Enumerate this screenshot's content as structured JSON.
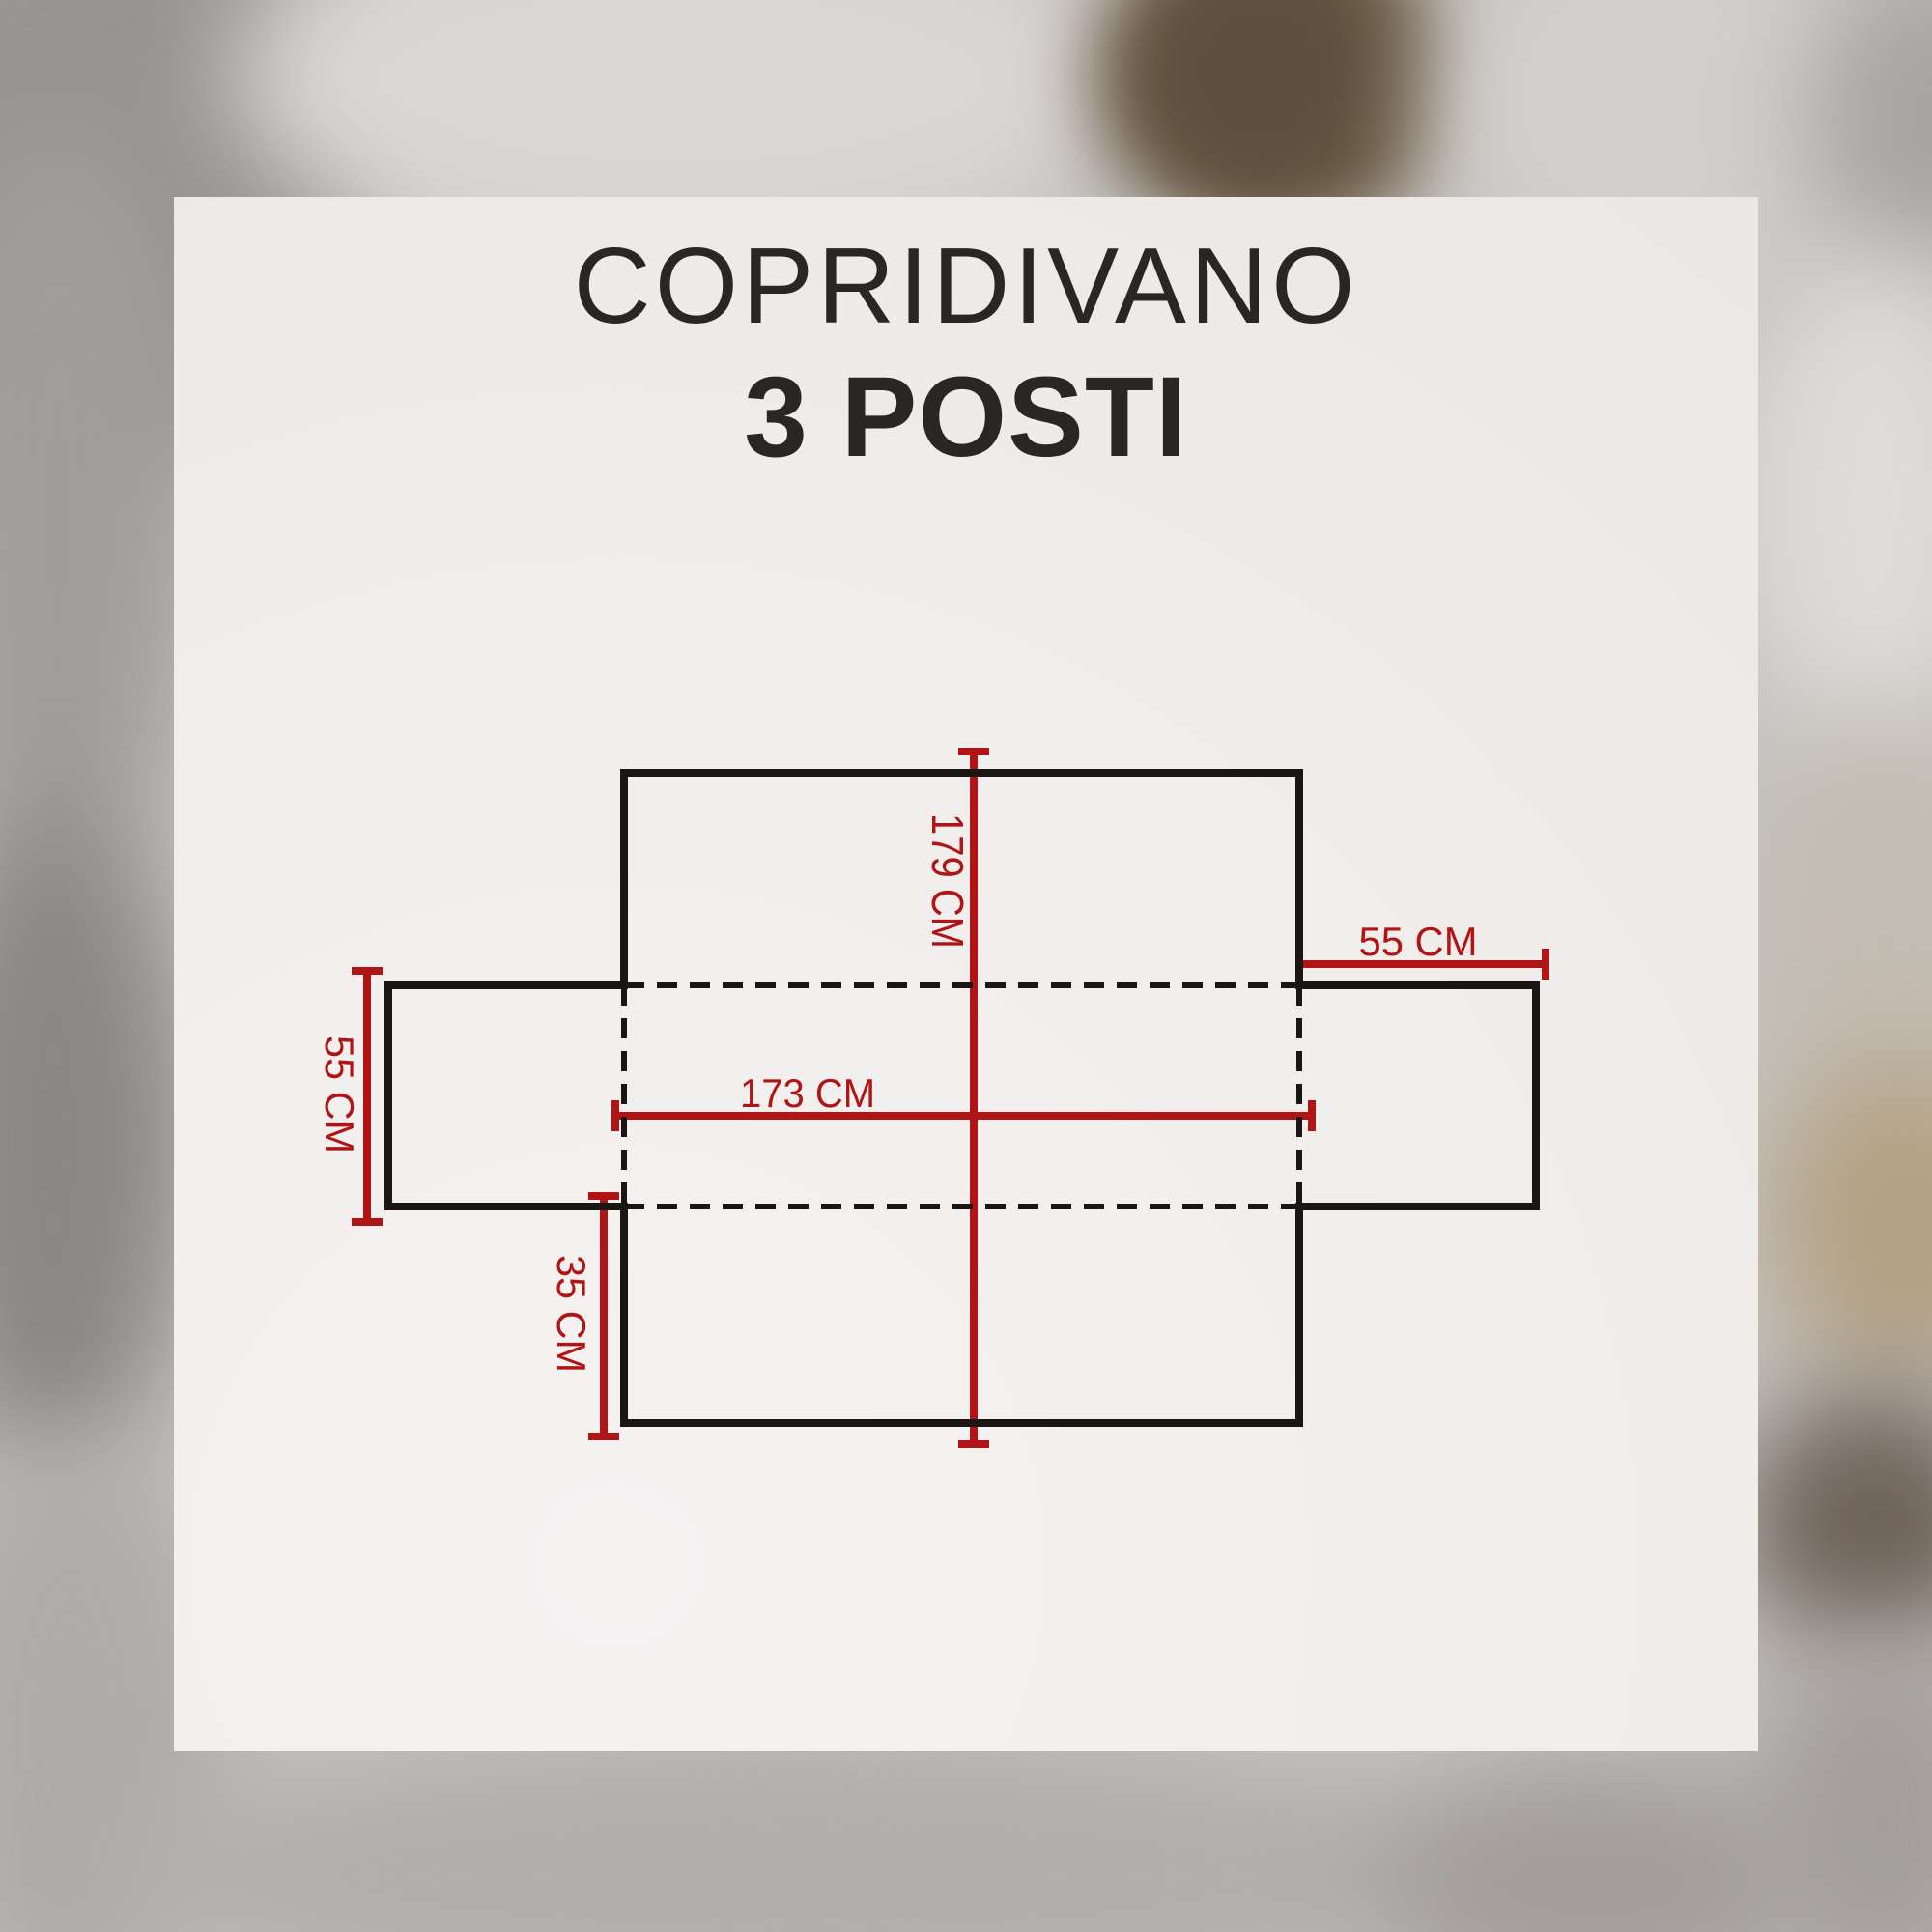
{
  "title": {
    "line1": "COPRIDIVANO",
    "line2": "3 POSTI"
  },
  "diagram": {
    "type": "sofa-cover-flat-pattern",
    "dimensions": {
      "back_height": "179 CM",
      "seat_width": "173 CM",
      "left_armrest": "55 CM",
      "right_armrest": "55 CM",
      "front_flap": "35 CM"
    }
  },
  "colors": {
    "dimension_red": "#b11414",
    "outline_black": "#1a1613",
    "card_background": "#f0edeb",
    "title_text": "#292624"
  }
}
